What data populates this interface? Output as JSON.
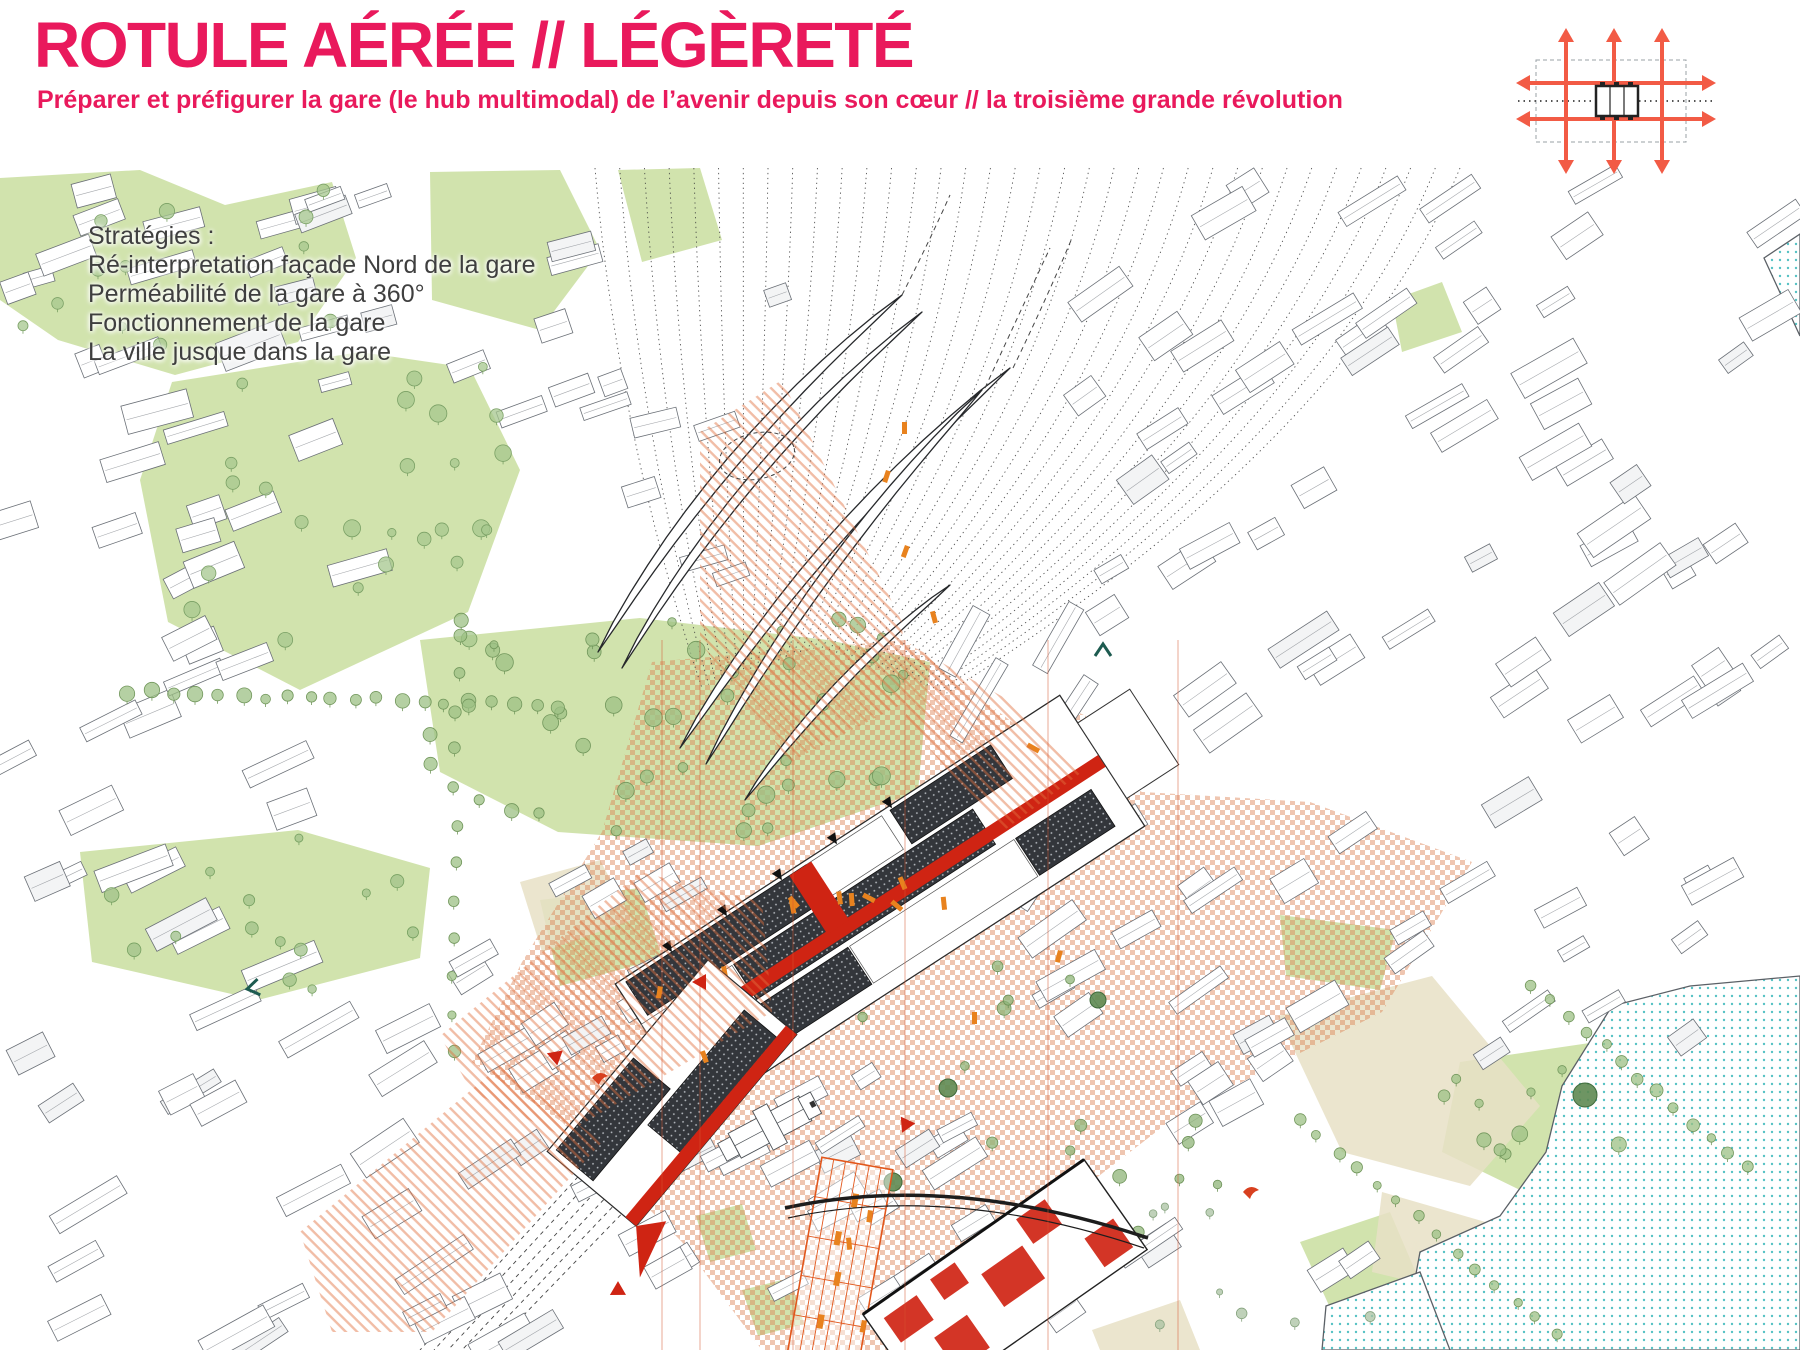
{
  "header": {
    "title": "ROTULE AÉRÉE // LÉGÈRETÉ",
    "subtitle": "Préparer et préfigurer la gare (le hub multimodal) de l’avenir depuis son cœur // la troisième grande révolution"
  },
  "strategies": {
    "heading": "Stratégies :",
    "items": [
      "Ré-interpretation façade Nord de la gare",
      "Perméabilité de la gare à 360°",
      "Fonctionnement de la gare",
      "La ville jusque dans la gare"
    ]
  },
  "legend_icon": {
    "name": "multimodal-flows-diagram",
    "description": "station crossed by vertical and horizontal flow arrows"
  },
  "palette": {
    "accent": "#e9195c",
    "arrow": "#f25b45",
    "hatch": "#e0703f",
    "checker": "#dd8152",
    "red": "#cf2413",
    "orange": "#e8821e",
    "orangeLine": "#e2571c",
    "roof": "#33363b",
    "park": "#cfe2a9",
    "beige": "#e7e0c6",
    "water": "#56c2c4",
    "line": "#6b7077",
    "teal": "#1d5b50"
  },
  "map": {
    "parks": [
      "0,300 0,178 140,170 225,205 332,182 356,258 298,342 175,375 58,340",
      "140,480 172,382 360,352 470,368 520,470 468,612 300,690 168,622",
      "420,640 640,618 828,640 930,662 918,792 758,846 558,832 440,772",
      "80,852 298,830 430,868 420,958 258,1000 92,962",
      "540,900 640,888 662,958 560,986",
      "430,172 560,170 600,250 540,330 432,300",
      "618,170 700,168 722,240 642,262",
      "1280,915 1396,930 1380,990 1286,976",
      "1460,1062 1610,1040 1640,1140 1520,1190 1442,1152",
      "1300,1242 1390,1212 1420,1282 1332,1312",
      "1392,300 1442,282 1462,332 1402,352",
      "696,1216 742,1204 756,1250 710,1262",
      "742,1290 790,1278 804,1324 758,1336"
    ],
    "plazas": [
      "1278,1016 1432,976 1540,1106 1470,1186 1342,1152",
      "1382,1192 1520,1232 1498,1302 1372,1272",
      "520,882 600,860 632,920 542,952",
      "1092,1330 1180,1300 1200,1350 1100,1350"
    ],
    "water": [
      "1612,1006 1690,986 1800,976 1800,1350 1402,1350 1420,1252 1500,1216 1546,1152 1562,1086",
      "1326,1306 1420,1272 1450,1350 1322,1350",
      "1764,258 1800,234 1800,336"
    ],
    "zones": {
      "checker": [
        "652,662 905,640 1012,722 1142,792 1310,802 1472,862 1382,1012 1182,1112 1052,1212 932,1350 762,1350 682,1242 562,1122 472,1062 522,962 602,832",
        "1052,700 1086,716 1062,882 1030,862"
      ],
      "hatch": [
        "700,432 782,380 902,622 906,702 790,762 700,642",
        "440,1036 640,872 762,902 772,1012 562,1136 472,1092",
        "300,1232 500,1066 602,1142 432,1332 332,1332",
        "905,642 1012,702 1082,772 1002,832 906,722"
      ]
    },
    "rails": {
      "n": 36,
      "y": 168,
      "x0": 595,
      "x1": 1460,
      "cx": 815,
      "cy": 648
    },
    "railsSW": {
      "n": 6,
      "x": 648,
      "y": 1100,
      "dx": 9,
      "dy": 8,
      "ex": 420,
      "ey": 1350,
      "edx": 14
    },
    "clusters": [
      {
        "x": 0,
        "y": 168,
        "w": 400,
        "h": 410,
        "angle": -18,
        "n": 26,
        "bw": [
          26,
          70
        ],
        "bh": [
          14,
          30
        ]
      },
      {
        "x": 300,
        "y": 168,
        "w": 320,
        "h": 250,
        "angle": -18,
        "n": 12,
        "bw": [
          24,
          60
        ],
        "bh": [
          12,
          26
        ]
      },
      {
        "x": 0,
        "y": 560,
        "w": 300,
        "h": 450,
        "angle": -24,
        "n": 20,
        "bw": [
          30,
          80
        ],
        "bh": [
          14,
          30
        ]
      },
      {
        "x": 0,
        "y": 1010,
        "w": 560,
        "h": 335,
        "angle": -30,
        "n": 36,
        "bw": [
          30,
          85
        ],
        "bh": [
          14,
          32
        ],
        "p": 110
      },
      {
        "x": 520,
        "y": 1150,
        "w": 530,
        "h": 195,
        "angle": -30,
        "n": 20,
        "bw": [
          26,
          64
        ],
        "bh": [
          14,
          28
        ]
      },
      {
        "x": 470,
        "y": 840,
        "w": 245,
        "h": 225,
        "angle": -30,
        "n": 13,
        "bw": [
          22,
          56
        ],
        "bh": [
          12,
          26
        ]
      },
      {
        "x": 1080,
        "y": 168,
        "w": 715,
        "h": 735,
        "angle": -32,
        "n": 88,
        "bw": [
          26,
          72
        ],
        "bh": [
          14,
          30
        ],
        "p": 95
      },
      {
        "x": 1040,
        "y": 880,
        "w": 395,
        "h": 465,
        "angle": -32,
        "n": 30,
        "bw": [
          28,
          75
        ],
        "bh": [
          14,
          30
        ],
        "p": 100
      },
      {
        "x": 1430,
        "y": 860,
        "w": 285,
        "h": 195,
        "angle": -32,
        "n": 9,
        "bw": [
          26,
          60
        ],
        "bh": [
          13,
          26
        ]
      },
      {
        "x": 950,
        "y": 620,
        "w": 145,
        "h": 280,
        "angle": -58,
        "n": 7,
        "bw": [
          60,
          108
        ],
        "bh": [
          14,
          22
        ]
      },
      {
        "x": 600,
        "y": 290,
        "w": 200,
        "h": 290,
        "angle": -16,
        "n": 6,
        "bw": [
          22,
          50
        ],
        "bh": [
          12,
          22
        ]
      },
      {
        "x": 700,
        "y": 1060,
        "w": 300,
        "h": 115,
        "angle": -30,
        "n": 8,
        "bw": [
          24,
          56
        ],
        "bh": [
          12,
          24
        ]
      }
    ],
    "canopies": [
      {
        "a": [
          598,
          652
        ],
        "c": [
          715,
          450
        ],
        "b": [
          902,
          295
        ],
        "w": 12
      },
      {
        "a": [
          622,
          668
        ],
        "c": [
          735,
          468
        ],
        "b": [
          922,
          312
        ],
        "w": 10
      },
      {
        "a": [
          680,
          748
        ],
        "c": [
          808,
          540
        ],
        "b": [
          1010,
          368
        ],
        "w": 13
      },
      {
        "a": [
          706,
          764
        ],
        "c": [
          818,
          560
        ],
        "b": [
          982,
          390
        ],
        "w": 11
      },
      {
        "a": [
          745,
          800
        ],
        "c": [
          830,
          680
        ],
        "b": [
          950,
          585
        ],
        "w": 9
      }
    ],
    "canopyGuides": [
      "M1013,368 Q1046,300 1072,238",
      "M985,388 Q1020,312 1050,248",
      "M902,295 Q930,240 950,195"
    ],
    "station": {
      "cx": 880,
      "cy": 905,
      "angle": -33
    },
    "annex": {
      "cx": 672,
      "cy": 1093,
      "angle": -50
    },
    "church": {
      "cx": 770,
      "cy": 1127,
      "angle": -28
    },
    "market": {
      "cx": 840,
      "cy": 1262,
      "angle": 10
    },
    "redBuilding": {
      "cx": 1005,
      "cy": 1282,
      "angle": -35
    },
    "redlines": [
      662,
      700,
      793,
      905,
      1048,
      1178
    ],
    "trees": {
      "patches": [
        {
          "x": 430,
          "y": 618,
          "w": 495,
          "h": 218,
          "n": 46,
          "r0": 4,
          "r1": 9,
          "f": "#9cc084",
          "s": "#72975c"
        },
        {
          "x": 180,
          "y": 360,
          "w": 330,
          "h": 300,
          "n": 26,
          "r0": 4,
          "r1": 9,
          "f": "#a5c78e",
          "s": "#7aa065"
        },
        {
          "x": 0,
          "y": 178,
          "w": 340,
          "h": 190,
          "n": 12,
          "r0": 4,
          "r1": 8,
          "f": "#a5c78e",
          "s": "#7aa065"
        },
        {
          "x": 90,
          "y": 832,
          "w": 330,
          "h": 160,
          "n": 14,
          "r0": 4,
          "r1": 8,
          "f": "#a0c289",
          "s": "#76a061"
        },
        {
          "x": 620,
          "y": 900,
          "w": 460,
          "h": 290,
          "n": 10,
          "r0": 4,
          "r1": 7,
          "f": "#8fb478",
          "s": "#6d9258"
        },
        {
          "x": 960,
          "y": 1060,
          "w": 280,
          "h": 240,
          "n": 8,
          "r0": 4,
          "r1": 7,
          "f": "#8fb478",
          "s": "#6d9258"
        },
        {
          "x": 1440,
          "y": 1050,
          "w": 190,
          "h": 130,
          "n": 10,
          "r0": 4,
          "r1": 8,
          "f": "#9cc084",
          "s": "#72975c"
        },
        {
          "x": 1130,
          "y": 1180,
          "w": 260,
          "h": 150,
          "n": 8,
          "r0": 3,
          "r1": 6,
          "f": "#a9c2a2",
          "s": "#86a37e"
        }
      ],
      "rows": [
        {
          "x1": 128,
          "y1": 692,
          "x2": 560,
          "y2": 706,
          "n": 20,
          "r": 6
        },
        {
          "x1": 1532,
          "y1": 986,
          "x2": 1748,
          "y2": 1168,
          "n": 13,
          "r": 5
        },
        {
          "x1": 1298,
          "y1": 1118,
          "x2": 1556,
          "y2": 1336,
          "n": 14,
          "r": 5
        },
        {
          "x1": 458,
          "y1": 636,
          "x2": 452,
          "y2": 1050,
          "n": 12,
          "r": 5
        }
      ],
      "big": [
        [
          1012,
          858,
          11
        ],
        [
          948,
          1088,
          9
        ],
        [
          1098,
          1000,
          8
        ],
        [
          845,
          940,
          8
        ],
        [
          893,
          1182,
          9
        ],
        [
          1585,
          1095,
          12
        ],
        [
          762,
          1012,
          8
        ]
      ]
    },
    "marks": {
      "figs": [
        [
          905,
          545,
          20
        ],
        [
          930,
          612,
          -15
        ],
        [
          658,
          986,
          10
        ],
        [
          700,
          1052,
          -20
        ],
        [
          1058,
          950,
          15
        ],
        [
          972,
          1012,
          0
        ],
        [
          868,
          1210,
          8
        ],
        [
          846,
          1238,
          -6
        ],
        [
          862,
          1320,
          12
        ],
        [
          902,
          422,
          0
        ],
        [
          886,
          470,
          18
        ]
      ],
      "tris": [
        [
          706,
          982,
          180
        ],
        [
          908,
          1120,
          115
        ],
        [
          622,
          1288,
          150
        ],
        [
          560,
          1058,
          200
        ]
      ],
      "birds": [
        [
          592,
          1078
        ],
        [
          1243,
          1192
        ]
      ],
      "chevrons": [
        [
          253,
          988,
          -100
        ],
        [
          1103,
          650,
          0
        ]
      ],
      "ellipse": {
        "cx": 757,
        "cy": 456,
        "rx": 38,
        "ry": 23,
        "rot": -12
      },
      "stationArrows": [
        [
          666,
          943
        ],
        [
          721,
          907
        ],
        [
          776,
          871
        ],
        [
          831,
          835
        ],
        [
          886,
          799
        ]
      ]
    }
  }
}
